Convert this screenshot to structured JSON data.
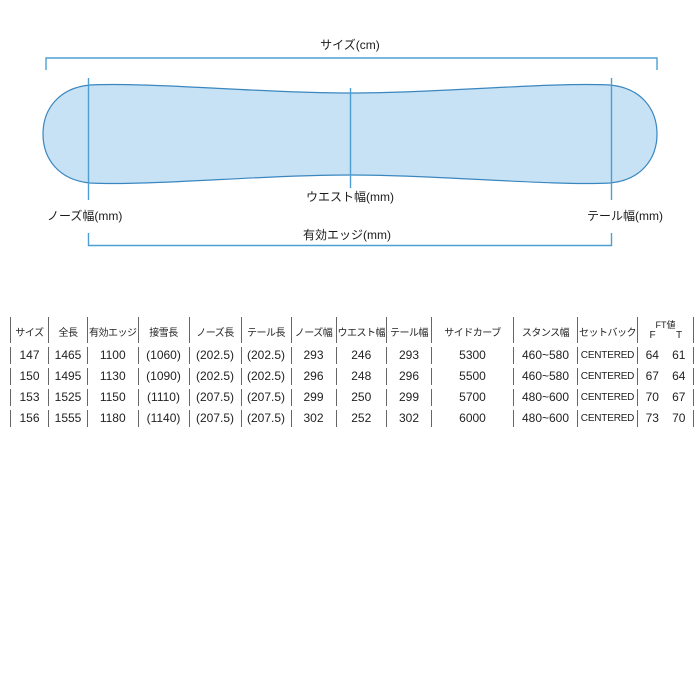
{
  "diagram": {
    "size_label": "サイズ(cm)",
    "waist_label": "ウエスト幅(mm)",
    "nose_label": "ノーズ幅(mm)",
    "tail_label": "テール幅(mm)",
    "edge_label": "有効エッジ(mm)",
    "board_fill": "#c7e2f4",
    "board_stroke": "#3a87c0",
    "line_color": "#4d9fd3"
  },
  "table": {
    "headers": [
      "サイズ",
      "全長",
      "有効エッジ",
      "接雪長",
      "ノーズ長",
      "テール長",
      "ノーズ幅",
      "ウエスト幅",
      "テール幅",
      "サイドカーブ",
      "スタンス幅",
      "セットバック"
    ],
    "ft_header": {
      "label": "FT値",
      "f": "F",
      "t": "T"
    },
    "rows": [
      [
        "147",
        "1465",
        "1100",
        "(1060)",
        "(202.5)",
        "(202.5)",
        "293",
        "246",
        "293",
        "5300",
        "460~580",
        "CENTERED",
        "64",
        "61"
      ],
      [
        "150",
        "1495",
        "1130",
        "(1090)",
        "(202.5)",
        "(202.5)",
        "296",
        "248",
        "296",
        "5500",
        "460~580",
        "CENTERED",
        "67",
        "64"
      ],
      [
        "153",
        "1525",
        "1150",
        "(1110)",
        "(207.5)",
        "(207.5)",
        "299",
        "250",
        "299",
        "5700",
        "480~600",
        "CENTERED",
        "70",
        "67"
      ],
      [
        "156",
        "1555",
        "1180",
        "(1140)",
        "(207.5)",
        "(207.5)",
        "302",
        "252",
        "302",
        "6000",
        "480~600",
        "CENTERED",
        "73",
        "70"
      ]
    ]
  }
}
